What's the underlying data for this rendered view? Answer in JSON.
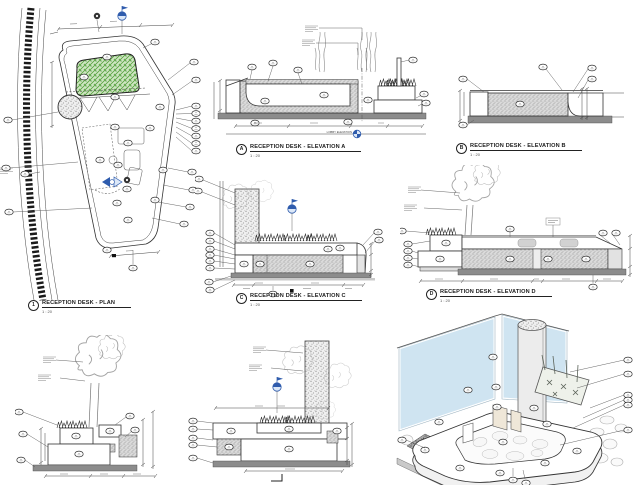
{
  "palette": {
    "paper": "#ffffff",
    "line": "#333333",
    "accent_blue": "#2f5cad",
    "planter_green_fill": "#cfe6c2",
    "planter_green_line": "#56a23f",
    "glass_blue": "#cfe4f1",
    "concrete_grey": "#d9d9d9",
    "base_grey": "#8c8c8c"
  },
  "drawings": {
    "plan": {
      "num": "1",
      "title": "RECEPTION DESK - PLAN",
      "scale": "1 : 20"
    },
    "elev_a": {
      "num": "A",
      "title": "RECEPTION DESK - ELEVATION A",
      "scale": "1 : 20"
    },
    "elev_b": {
      "num": "B",
      "title": "RECEPTION DESK - ELEVATION B",
      "scale": "1 : 20"
    },
    "elev_c": {
      "num": "C",
      "title": "RECEPTION DESK - ELEVATION C",
      "scale": "1 : 20"
    },
    "elev_d": {
      "num": "D",
      "title": "RECEPTION DESK - ELEVATION D",
      "scale": "1 : 20"
    }
  },
  "annotations": {
    "level_label": "LOBBY ELEVATION"
  },
  "icons": {
    "section_marker": "blue-section-flag-marker",
    "level_marker": "blue-level-target-marker",
    "plan_section_arrow": "blue-section-cut-arrow",
    "callout": "elliptical-keynote-bubble"
  }
}
